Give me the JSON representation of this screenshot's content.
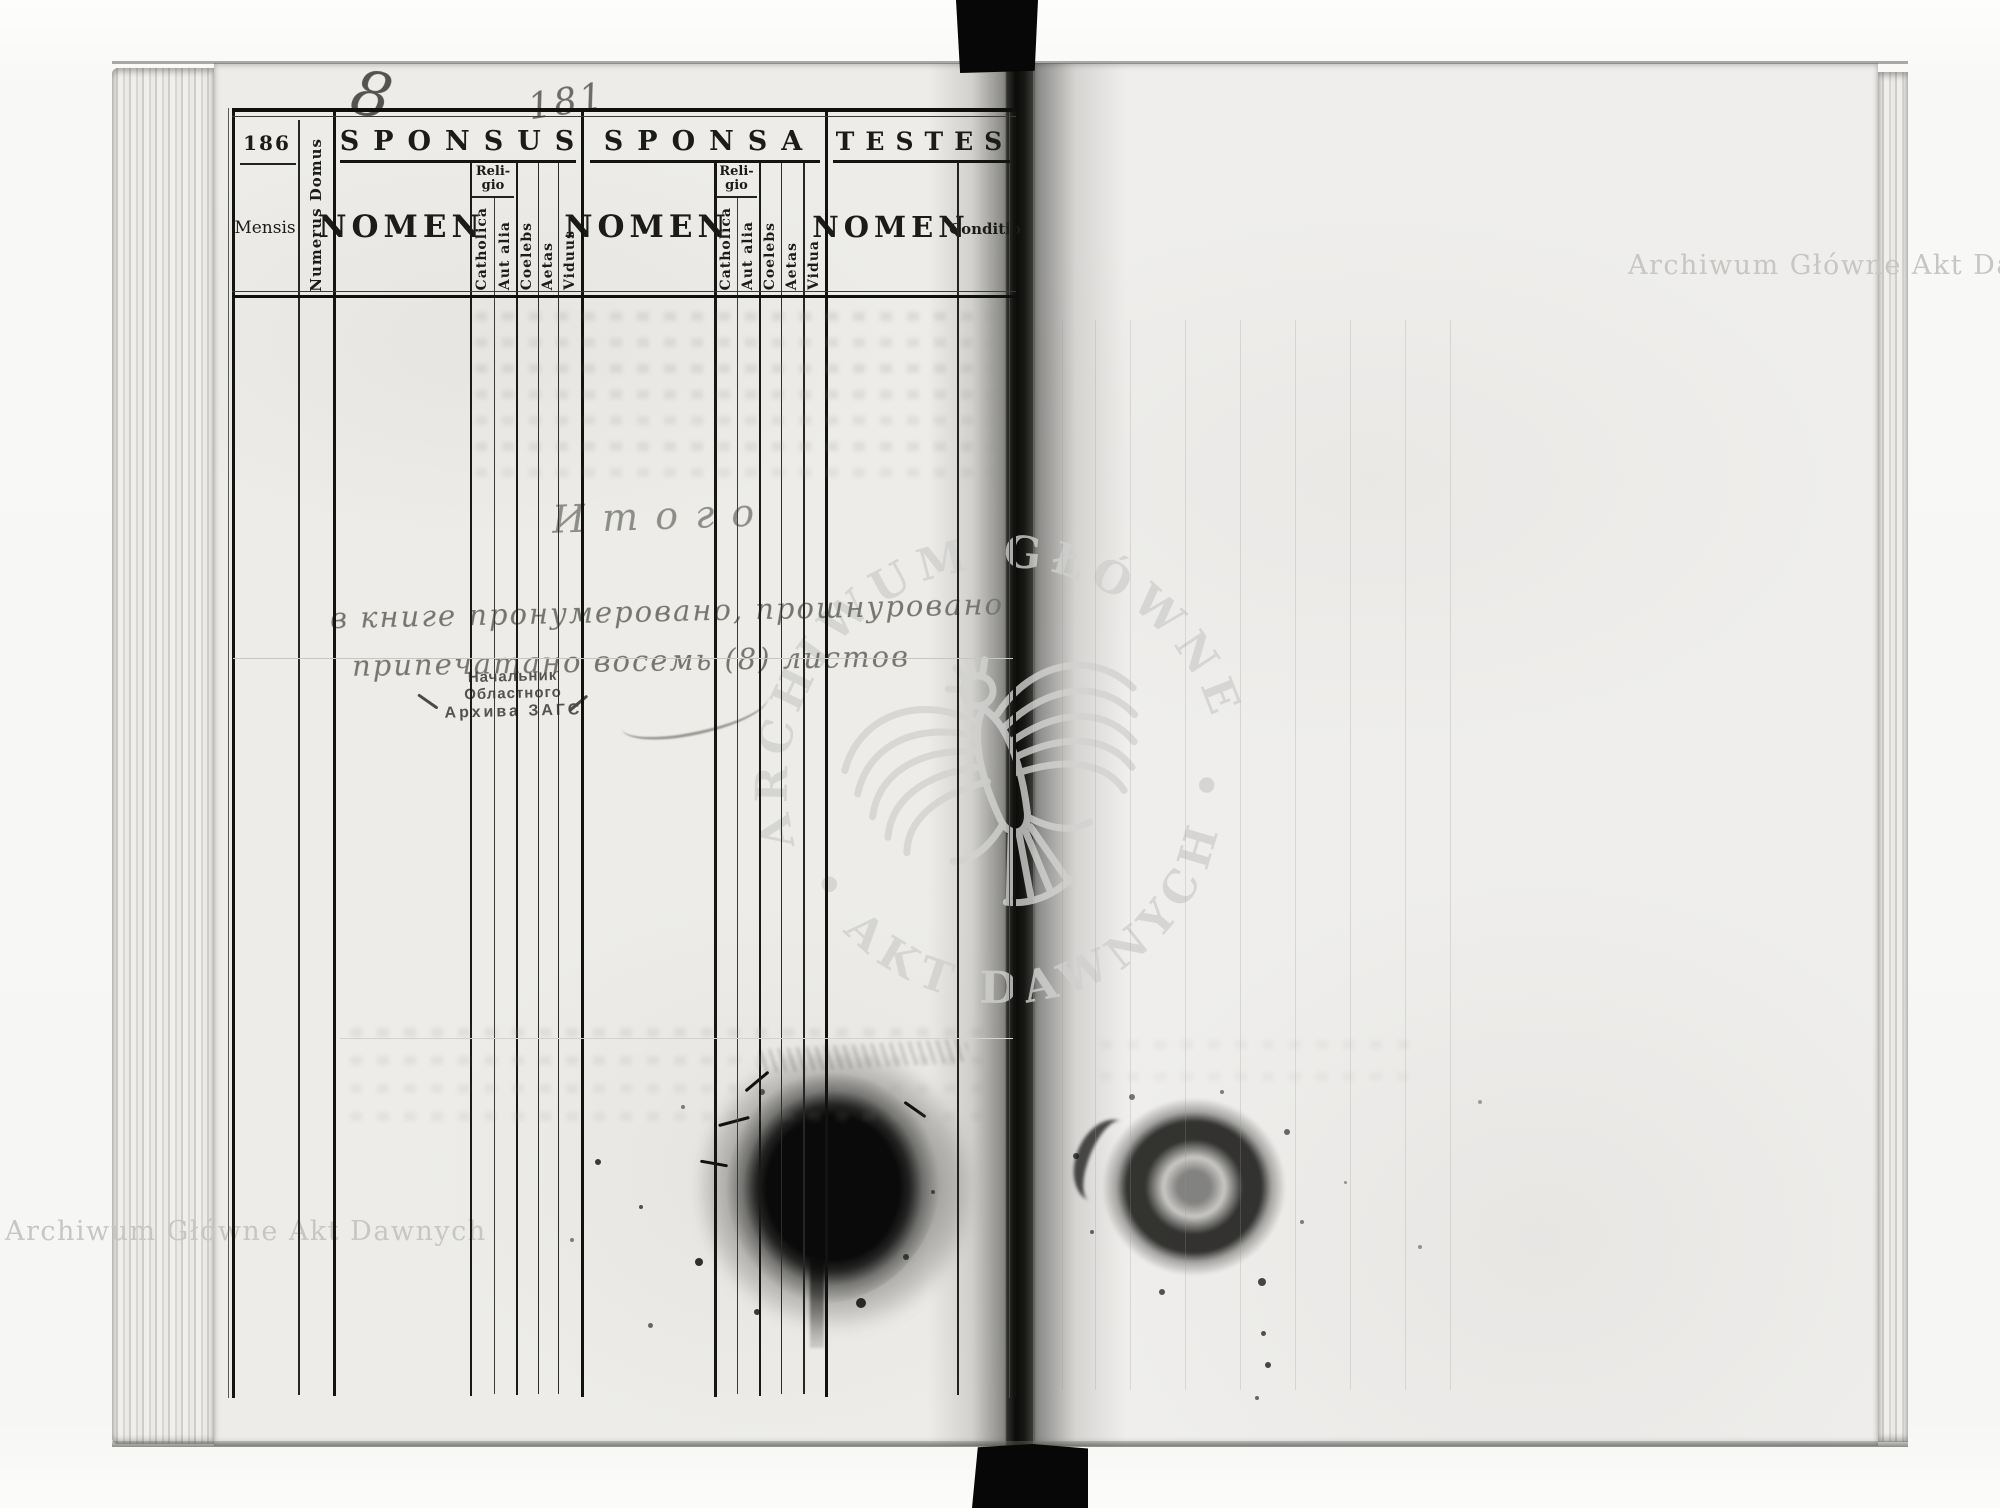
{
  "register": {
    "page_number": "186",
    "sections": {
      "sponsus": "SPONSUS",
      "sponsa": "SPONSA",
      "testes": "TESTES"
    },
    "columns": {
      "mensis": "Mensis",
      "numerus_domus": "Numerus Domus",
      "nomen": "NOMEN",
      "religio_line1": "Reli-",
      "religio_line2": "gio",
      "catholica": "Catholica",
      "aut_alia": "Aut alia",
      "coelebs": "Coelebs",
      "aetas": "Aetas",
      "viduus": "Viduus",
      "vidua": "Vidua",
      "conditio": "Conditio"
    }
  },
  "annotations": {
    "leaf_count_mark": "8",
    "page_mark": "181",
    "total": "Итого",
    "cert_line1": "в книге пронумеровано, прошнуровано",
    "cert_line2": "припечатано восемь (8) листов"
  },
  "stamp": {
    "line1": "Начальник Областного",
    "line2": "Архива ЗАГС"
  },
  "watermarks": {
    "corner_text": "Archiwum Główne Akt Dawnych",
    "seal_top": "ARCHIWUM GŁÓWNE",
    "seal_bottom": "• AKT DAWNYCH •"
  },
  "colors": {
    "paper": "#edece9",
    "print_ink": "#141414",
    "pencil": "#75756f",
    "stamp_ink": "#3e3e3c",
    "watermark": "#cfcfcd",
    "blot": "#0d0d0d"
  }
}
